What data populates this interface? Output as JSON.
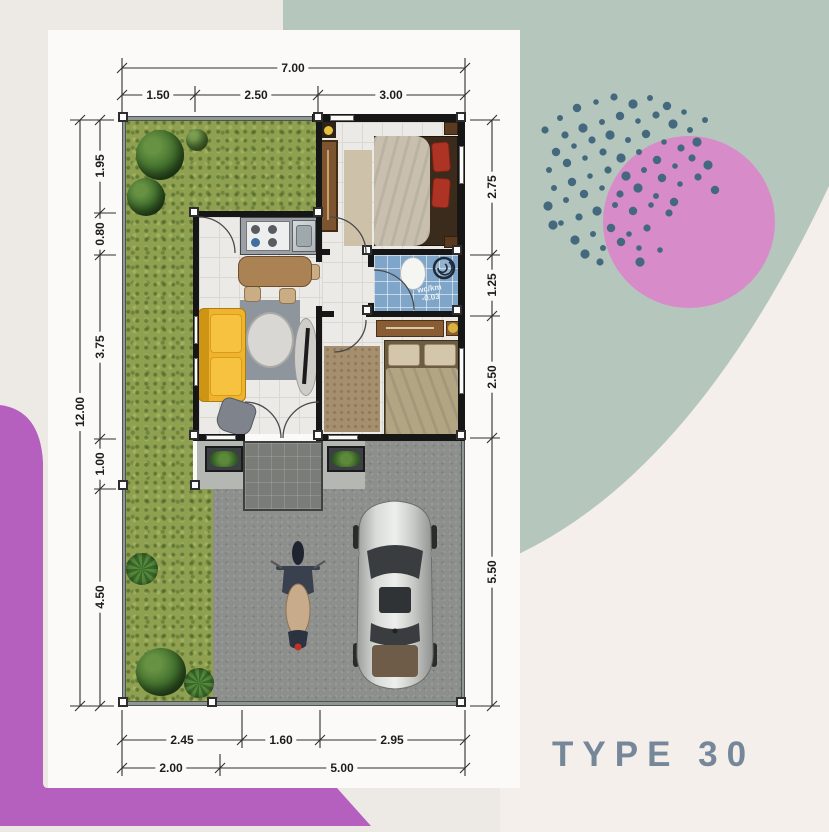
{
  "title": "TYPE 30",
  "bathroom": {
    "line1": "wc/km",
    "line2": "-0.03"
  },
  "dims": {
    "top_total": "7.00",
    "top_segments": [
      "1.50",
      "2.50",
      "3.00"
    ],
    "left_total": "12.00",
    "left_segments": [
      "1.95",
      "0.80",
      "3.75",
      "1.00",
      "4.50"
    ],
    "right_segments": [
      "2.75",
      "1.25",
      "2.50",
      "5.50"
    ],
    "bottom_row1": [
      "2.45",
      "1.60",
      "2.95"
    ],
    "bottom_row2": [
      "2.00",
      "5.00"
    ]
  },
  "colors": {
    "background": "#EDEAE6",
    "panel": "#FBFAF8",
    "offwhite": "#F4EFEA",
    "sage": "#B5C7BC",
    "pink_circle": "#D78BC8",
    "dot_blue": "#44697E",
    "purple": "#B560BE",
    "title_text": "#76879A",
    "dim_text": "#1D1D1D",
    "grass": "#8FA050",
    "concrete": "#8D8F8C",
    "wall": "#161616",
    "bathroom_tile": "#7FA6C8",
    "sofa_yellow": "#EFB32D"
  }
}
